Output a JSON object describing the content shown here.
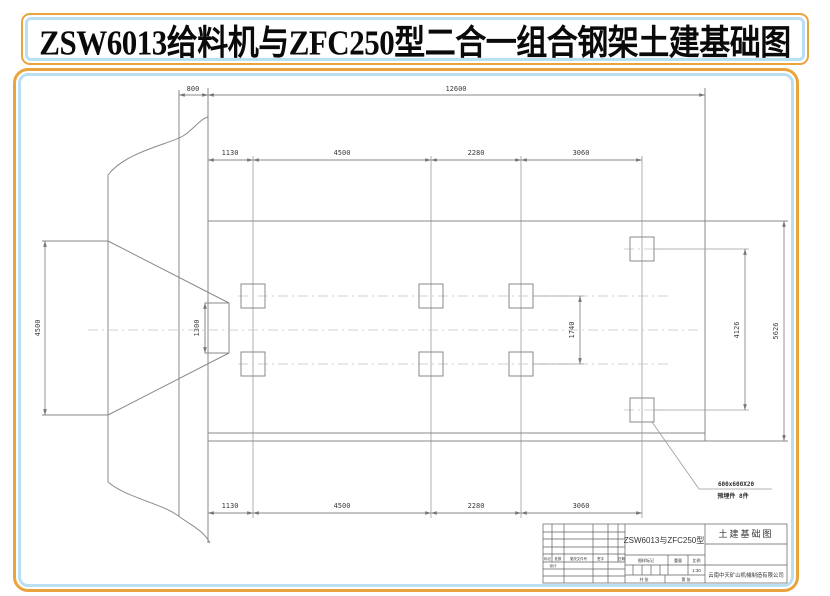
{
  "banner": {
    "title": "ZSW6013给料机与ZFC250型二合一组合钢架土建基础图"
  },
  "colors": {
    "accent_orange": "#e9a43e",
    "accent_blue": "#badef2",
    "line_gray": "#8a8a8a",
    "dim_text": "#3b3b3b"
  },
  "dims": {
    "offset_800": "800",
    "overall_12600": "12600",
    "top_row": [
      "1130",
      "4500",
      "2280",
      "3060"
    ],
    "bottom_row": [
      "1130",
      "4500",
      "2280",
      "3060"
    ],
    "hopper_4500": "4500",
    "outlet_1300": "1300",
    "pads_1740": "1740",
    "pads_4126": "4126",
    "slab_5626": "5626"
  },
  "callout": {
    "size": "600x600X20",
    "label": "预埋件  8件"
  },
  "title_block": {
    "model": "ZSW6013与ZFC250型",
    "drawing_title": "土建基础图",
    "company": "云南中天矿山机械制造有限公司",
    "rev_headers": [
      "标记",
      "处数",
      "更改文件号",
      "签字",
      "日期"
    ],
    "design_label": "设计",
    "mark_header": "图样标记",
    "weight_header": "重量",
    "scale_header": "比例",
    "scale_value": "1:30",
    "sheet_total": "共 张",
    "sheet_no": "第 张"
  }
}
